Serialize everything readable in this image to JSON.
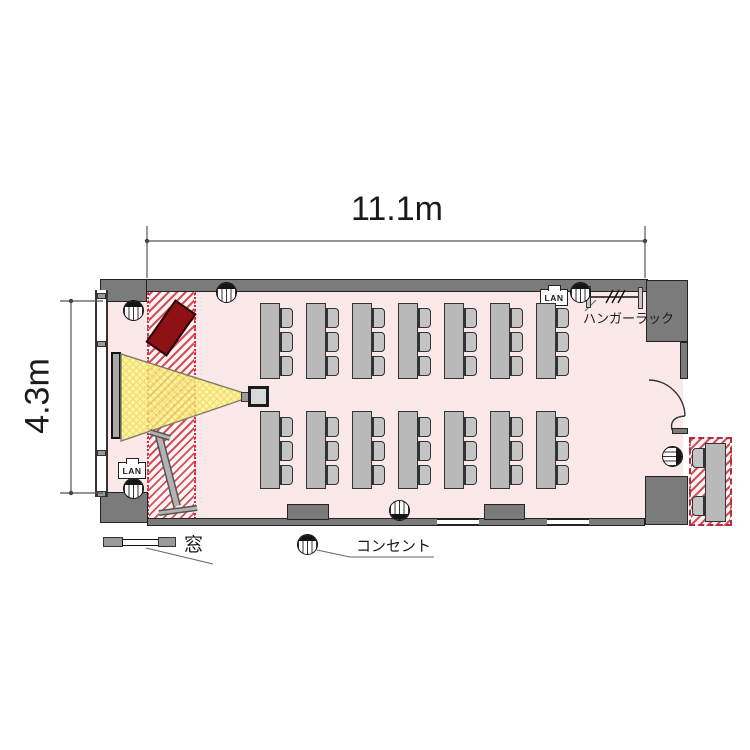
{
  "plan": {
    "type": "meeting-room floor plan",
    "dimensions": {
      "width_label": "11.1m",
      "height_label": "4.3m"
    },
    "labels": {
      "hanger_rack": "ハンガーラック",
      "window": "窓",
      "outlet": "コンセント",
      "lan": "LAN"
    },
    "furniture": {
      "table_columns": 7,
      "table_rows": 2,
      "chairs_per_table": 3,
      "outside_tables": 1,
      "outside_chairs": 2
    },
    "equipment": [
      "screen",
      "projector",
      "whiteboard",
      "hanger-rack",
      "door",
      "outlets",
      "lan-ports"
    ],
    "outlet_symbol_count": 7,
    "colors": {
      "floor": "#fbe9e9",
      "wall": "#7b7b7b",
      "hatch_stripe": "#d44f5b",
      "table": "#b9b9b9",
      "beam_yellow": "#fdf590",
      "board_red": "#8e1215",
      "screen_gray": "#a8a8a8"
    }
  }
}
